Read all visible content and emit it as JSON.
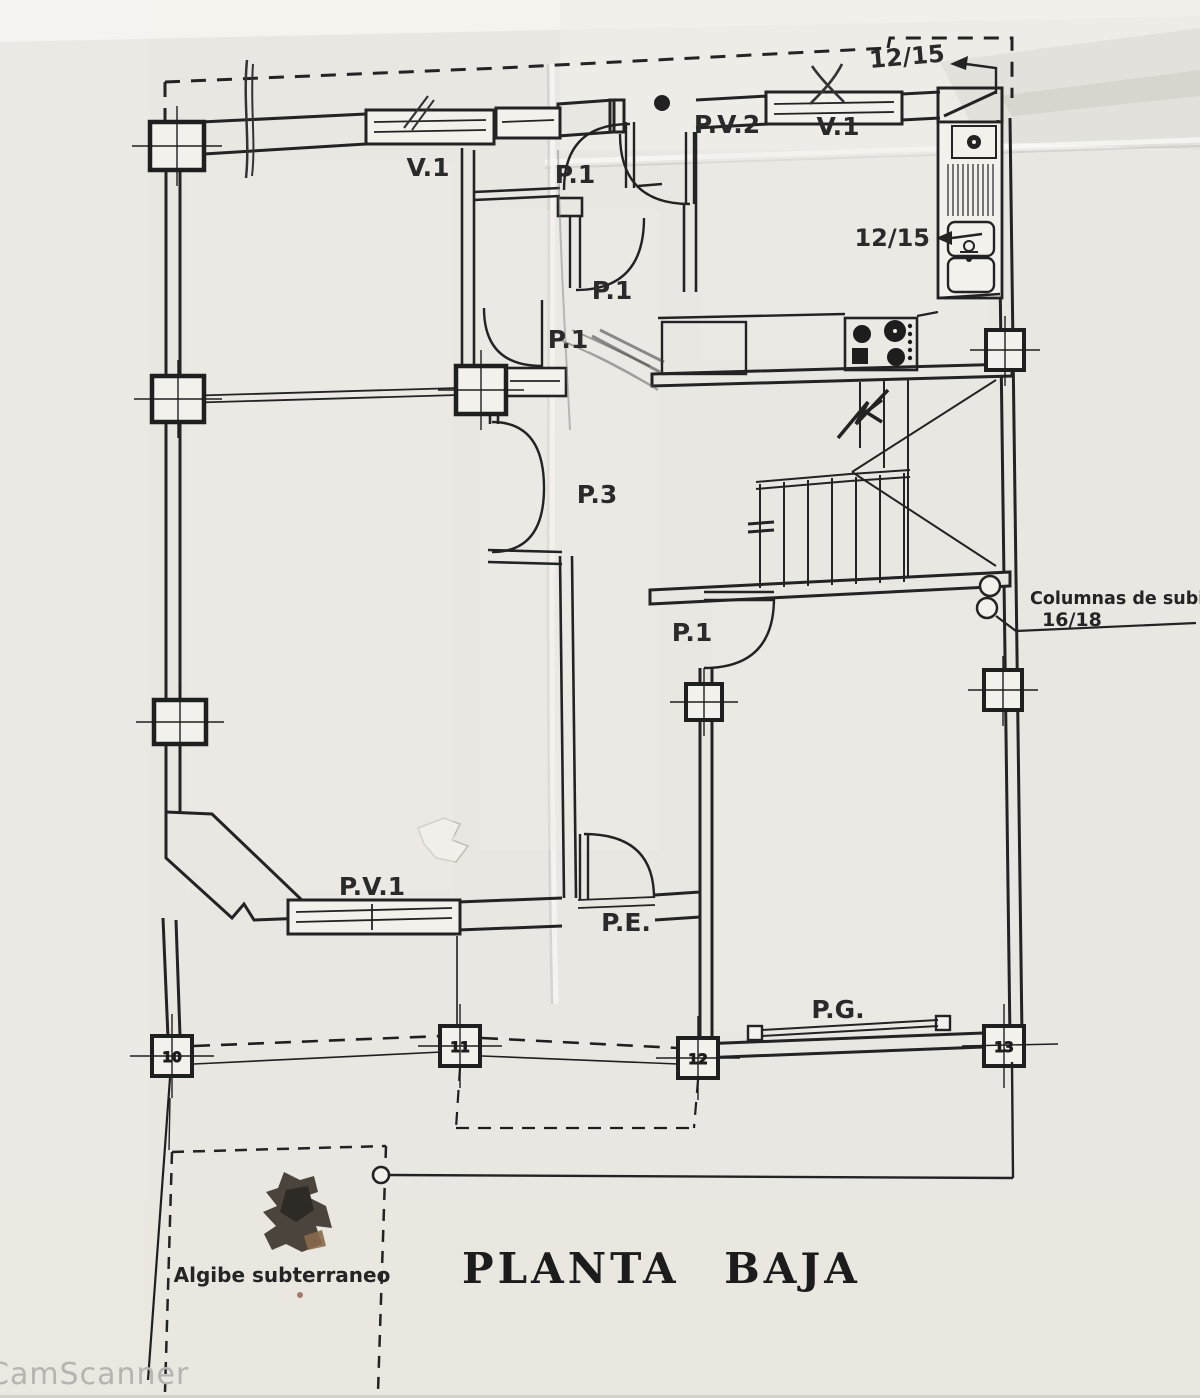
{
  "title": "PLANTA BAJA",
  "watermark": "CamScanner",
  "labels": {
    "window_living": "V.1",
    "window_kitchen": "V.1",
    "door_pv2": "P.V.2",
    "door_p1_top": "P.1",
    "door_p1_mid": "P.1",
    "door_p1_low": "P.1",
    "door_p1_hall": "P.1",
    "door_p3": "P.3",
    "door_pv1": "P.V.1",
    "door_entry": "P.E.",
    "door_garage": "P.G.",
    "beam_ref_top": "12/15",
    "sink_ref": "12/15",
    "columns_note": "Columnas de subida",
    "columns_size": "16/18",
    "cistern": "Algibe subterraneo"
  },
  "grid_columns": [
    "10",
    "11",
    "12",
    "13"
  ]
}
